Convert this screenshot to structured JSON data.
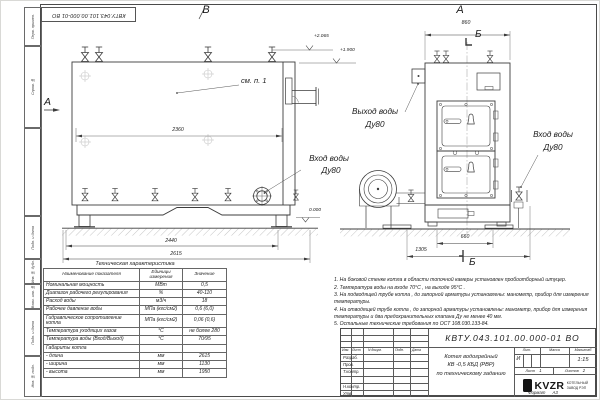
{
  "sheet": {
    "top_stamp": "КВТУ.043.101.00.000-01 ВО",
    "side_labels": [
      "Перв. примен.",
      "Справ. №",
      "Подп. и дата",
      "Инв. № дубл.",
      "Взам. инв. №",
      "Подп. и дата",
      "Инв. № подл."
    ],
    "format_label": "Формат",
    "format_value": "А3"
  },
  "views": {
    "front": {
      "label": "В",
      "view_arrow_label": "А",
      "see_note": "см. п. 1",
      "dim_top": "2360",
      "dim_mid": "2440",
      "dim_bottom": "2615",
      "elev_1": "+2.065",
      "elev_2": "+1.900",
      "elev_zero": "0.000",
      "inlet_line1": "Вход воды",
      "inlet_line2": "Ду80"
    },
    "side": {
      "label": "А",
      "dim_top": "860",
      "dim_base": "660",
      "dim_bottom": "1305",
      "section_top": "Б",
      "section_bottom": "Б",
      "outlet_line1": "Выход воды",
      "outlet_line2": "Ду80",
      "inlet_line1": "Вход воды",
      "inlet_line2": "Ду80"
    }
  },
  "notes": [
    "1.  На боковой стенке котла в области топочной камеры установлен пробоотборный штуцер.",
    "2.  Температура воды на входе  70°С ,  на выходе  95°С .",
    "3.  На подводящей трубе котла , до запорной арматуры установлены:  манометр,  прибор для измерения температуры.",
    "4.  На отводящей трубе котла , до запорной арматуры установлены:  манометр,  прибор для измерения температуры и два предохранительных клапана  Ду не менее  40 мм.",
    "5.  Остальные технические требования по ОСТ  108.030.133-84."
  ],
  "spec": {
    "title": "Техническая характеристика",
    "headers": [
      "Наименование показателя",
      "Единицы измерения",
      "Значение"
    ],
    "rows": [
      {
        "name": "Номинальная мощность",
        "unit": "МВт",
        "value": "0,5"
      },
      {
        "name": "Диапазон рабочего регулирования",
        "unit": "%",
        "value": "40-110"
      },
      {
        "name": "Расход воды",
        "unit": "м3/ч",
        "value": "18"
      },
      {
        "name": "Рабочее давление воды",
        "unit": "МПа (кгс/см2)",
        "value": "0,6 (6,0)"
      },
      {
        "name": "Гидравлическое сопротивление котла",
        "unit": "МПа (кгс/см2)",
        "value": "0,06 (0,6)"
      },
      {
        "name": "Температура уходящих газов",
        "unit": "°С",
        "value": "не более 280"
      },
      {
        "name": "Температура воды (Вход/Выход)",
        "unit": "°С",
        "value": "70/95"
      },
      {
        "name": "Габариты котла",
        "unit": "",
        "value": ""
      },
      {
        "name": "- длина",
        "unit": "мм",
        "value": "2615"
      },
      {
        "name": "- ширина",
        "unit": "мм",
        "value": "1130"
      },
      {
        "name": "- высота",
        "unit": "мм",
        "value": "1950"
      }
    ]
  },
  "title_block": {
    "designation": "КВТУ.043.101.00.000-01  ВО",
    "name_line1": "Котел водогрейный",
    "name_line2": "КВ -0,5  КБД  (РВР)",
    "name_line3": "по техническому заданию",
    "rev": {
      "izm": "Изм.",
      "list": "Лист",
      "doc": "N докум.",
      "sign": "Подп.",
      "date": "Дата"
    },
    "roles": [
      "Разраб.",
      "Пров.",
      "Т.контр.",
      "Н.контр.",
      "Утв."
    ],
    "lit_label": "Лит.",
    "mass_label": "Масса",
    "scale_label": "Масштаб",
    "lit_value": "И",
    "scale_value": "1:15",
    "sheet_label": "Лист",
    "sheet_value": "1",
    "sheets_label": "Листов",
    "sheets_value": "2",
    "logo_text": "KVZR",
    "logo_sub1": "КОТЕЛЬНЫЙ",
    "logo_sub2": "ЗАВОД РЭП"
  }
}
